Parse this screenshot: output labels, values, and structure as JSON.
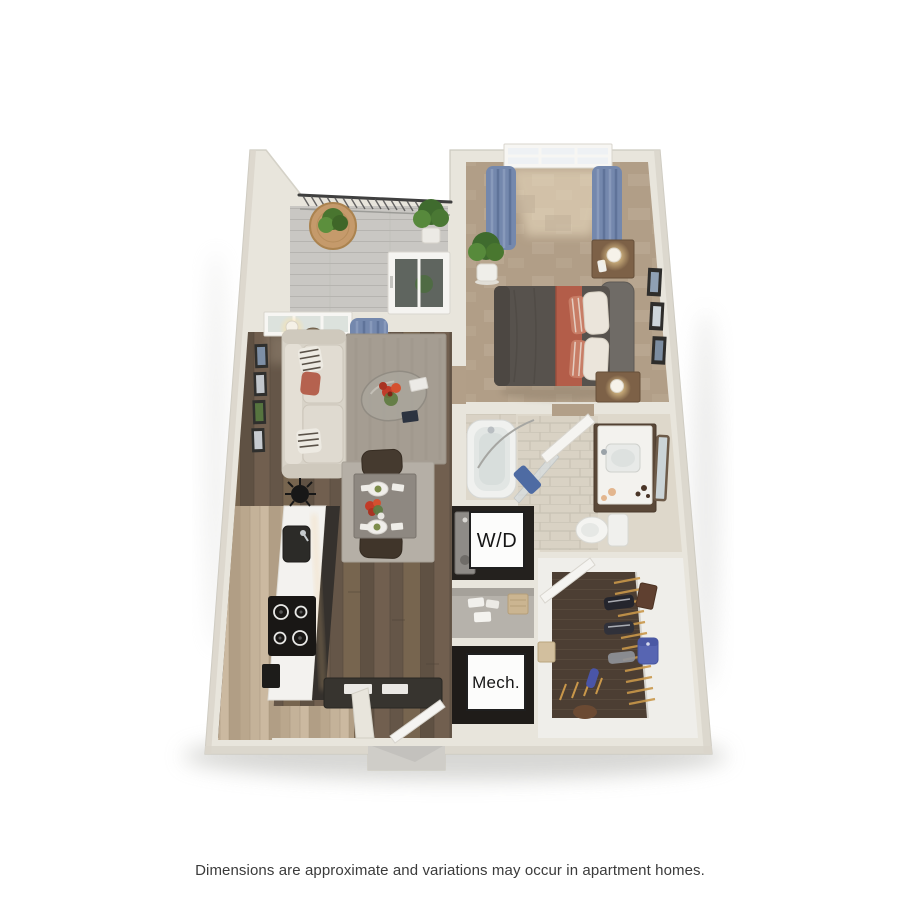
{
  "disclaimer": {
    "text": "Dimensions are approximate and variations may occur in apartment homes."
  },
  "floorplan": {
    "kind": "3D apartment floor plan rendering, one bedroom / one bath",
    "labels": {
      "washer_dryer": "W/D",
      "mechanical": "Mech."
    },
    "rooms": [
      "balcony",
      "living room",
      "dining area",
      "kitchen",
      "bedroom",
      "bathroom",
      "washer-dryer closet",
      "linen closet",
      "mechanical closet",
      "walk-in closet",
      "entry"
    ],
    "palette": {
      "background": "#ffffff",
      "wall": "#e8e5dc",
      "wall_shade": "#d9d5cb",
      "wood_floor_dark": "#6b5c4e",
      "wood_floor_light": "#c4b299",
      "carpet_bedroom": "#b19e87",
      "carpet_closet": "#4c3e33",
      "bath_tile": "#d8d1c3",
      "deck_gray": "#c9c7c3",
      "curtain_blue": "#7488ad",
      "accent_terracotta": "#b35d49",
      "duvet_gray": "#57524d",
      "sofa_cream": "#d8d3c8",
      "label_text": "#161616"
    }
  }
}
